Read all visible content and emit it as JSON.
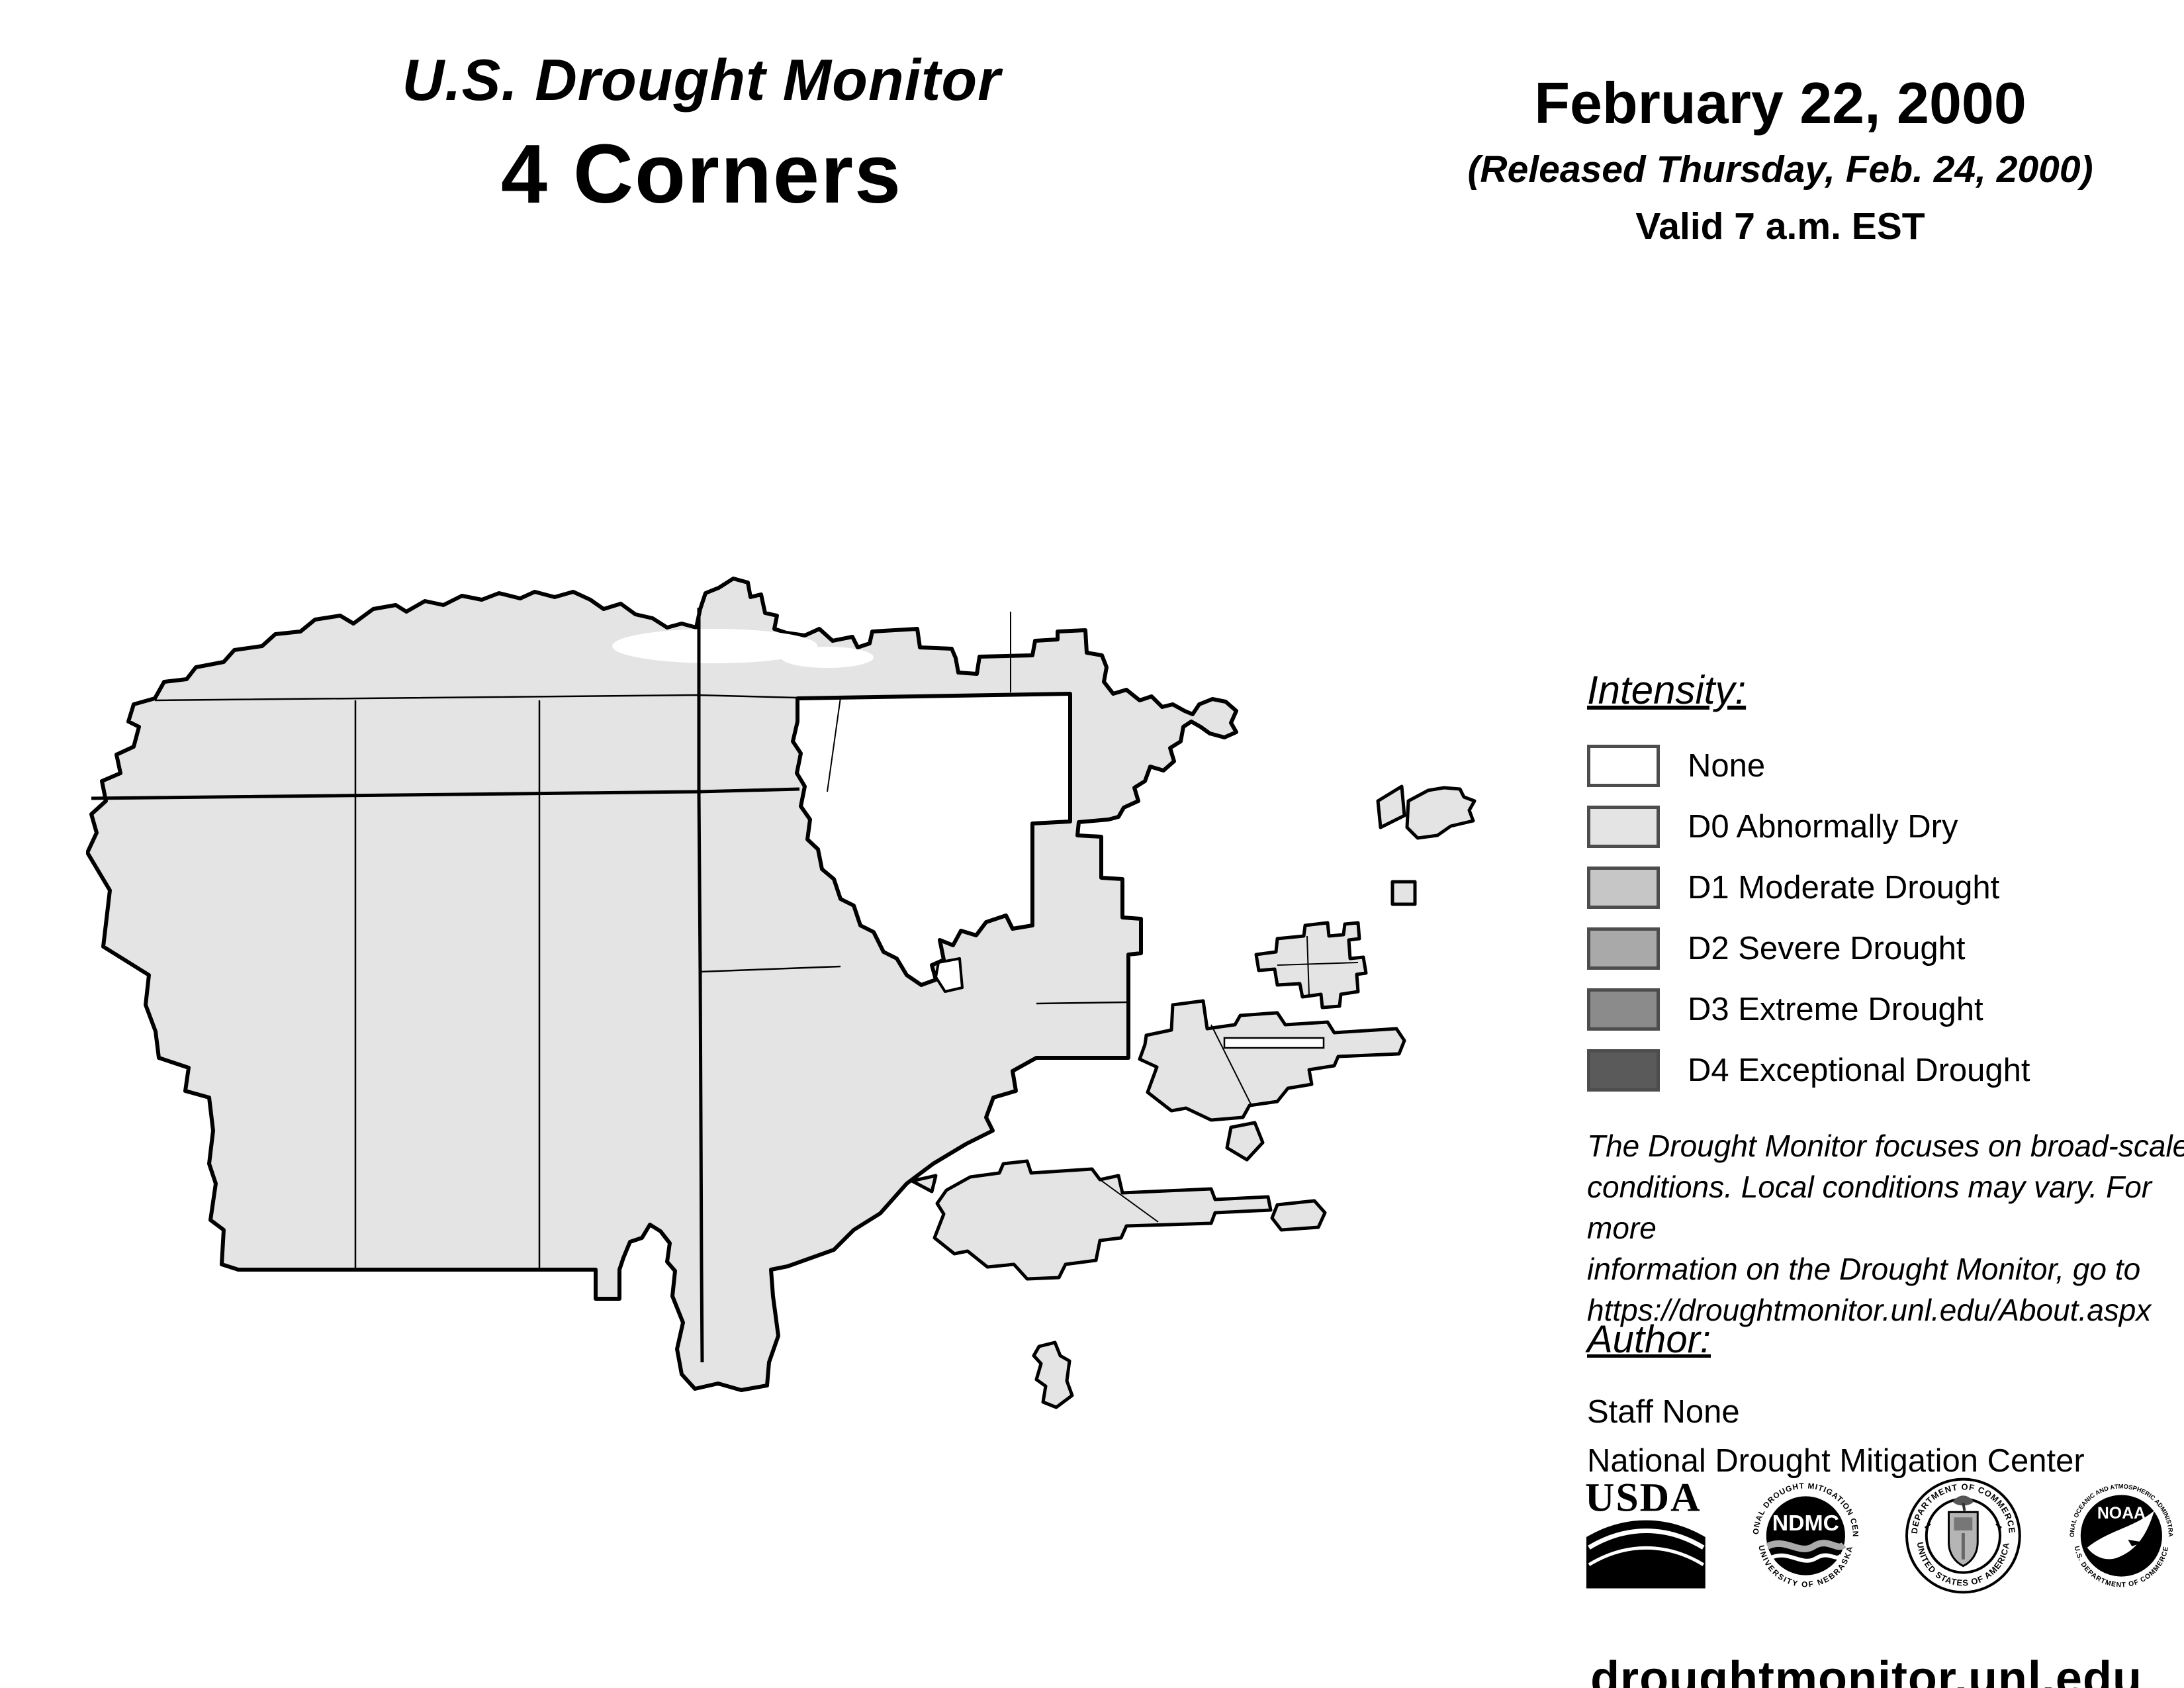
{
  "header": {
    "title": "U.S. Drought Monitor",
    "region": "4 Corners"
  },
  "date_block": {
    "date": "February 22, 2000",
    "released": "(Released Thursday, Feb. 24, 2000)",
    "valid": "Valid 7 a.m. EST"
  },
  "legend": {
    "heading": "Intensity:",
    "border_color": "#4d4d4d",
    "items": [
      {
        "label": "None",
        "color": "#ffffff"
      },
      {
        "label": "D0 Abnormally Dry",
        "color": "#e4e4e4"
      },
      {
        "label": "D1 Moderate Drought",
        "color": "#c6c6c6"
      },
      {
        "label": "D2 Severe Drought",
        "color": "#a9a9a9"
      },
      {
        "label": "D3 Extreme Drought",
        "color": "#8b8b8b"
      },
      {
        "label": "D4 Exceptional Drought",
        "color": "#5a5a5a"
      }
    ]
  },
  "map": {
    "fill_color": "#e4e4e4",
    "outline_color": "#000000",
    "depicted_intensity": "D0 Abnormally Dry"
  },
  "disclaimer": {
    "lines": [
      "The Drought Monitor focuses on broad-scale",
      "conditions. Local conditions may vary. For more",
      "information on the Drought Monitor, go to",
      "https://droughtmonitor.unl.edu/About.aspx"
    ]
  },
  "author": {
    "heading": "Author:",
    "name": "Staff None",
    "organization": "National Drought Mitigation Center"
  },
  "logos": {
    "usda": "USDA",
    "ndmc": "NDMC",
    "ndmc_rim_top": "NATIONAL DROUGHT MITIGATION CENTER",
    "ndmc_rim_bottom": "UNIVERSITY OF NEBRASKA",
    "doc_rim_top": "DEPARTMENT OF COMMERCE",
    "doc_rim_bottom": "UNITED STATES OF AMERICA",
    "noaa": "NOAA",
    "noaa_rim_top": "NATIONAL OCEANIC AND ATMOSPHERIC ADMINISTRATION",
    "noaa_rim_bottom": "U.S. DEPARTMENT OF COMMERCE"
  },
  "footer": {
    "url": "droughtmonitor.unl.edu"
  }
}
